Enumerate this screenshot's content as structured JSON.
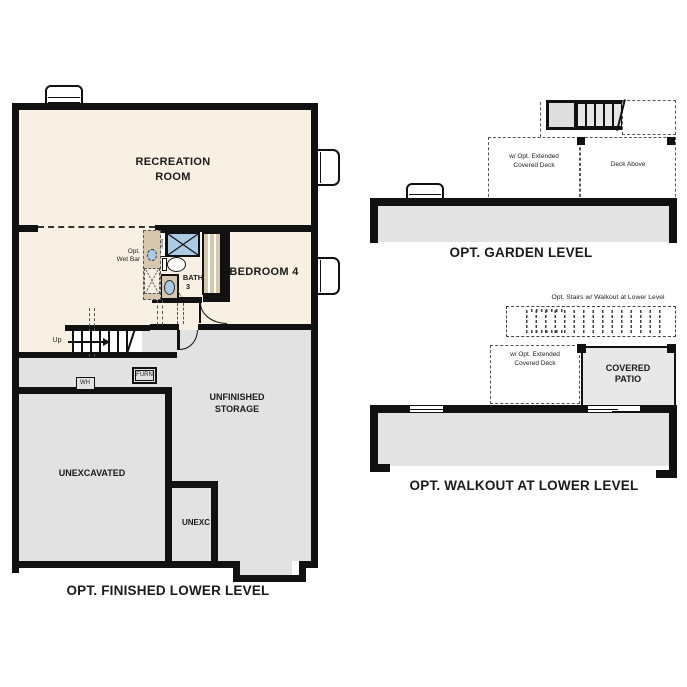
{
  "colors": {
    "wall": "#111111",
    "finished_floor": "#f8f0e2",
    "unfinished_floor": "#e2e2e2",
    "casework_tan": "#d5c8af",
    "fixture_blue": "#accae4",
    "patio_gray": "#e8e8e8"
  },
  "finished_lower": {
    "title": "OPT. FINISHED LOWER LEVEL",
    "labels": {
      "recreation_room": "RECREATION\nROOM",
      "bedroom4": "BEDROOM 4",
      "bath": "BATH",
      "bath_number": "3",
      "seat": "Seat",
      "opt_wet_bar": "Opt.\nWet Bar",
      "up": "Up",
      "wh": "WH",
      "furn": "FURN",
      "unfinished_storage": "UNFINISHED\nSTORAGE",
      "unexcavated": "UNEXCAVATED",
      "unexc": "UNEXC"
    }
  },
  "garden_level": {
    "title": "OPT. GARDEN LEVEL",
    "labels": {
      "extended_deck": "w/ Opt. Extended\nCovered Deck",
      "deck_above": "Deck Above"
    }
  },
  "walkout": {
    "title": "OPT. WALKOUT AT LOWER LEVEL",
    "labels": {
      "opt_stairs": "Opt. Stairs w/ Walkout at Lower Level",
      "extended_deck": "w/ Opt. Extended\nCovered Deck",
      "covered_patio": "COVERED\nPATIO"
    }
  }
}
